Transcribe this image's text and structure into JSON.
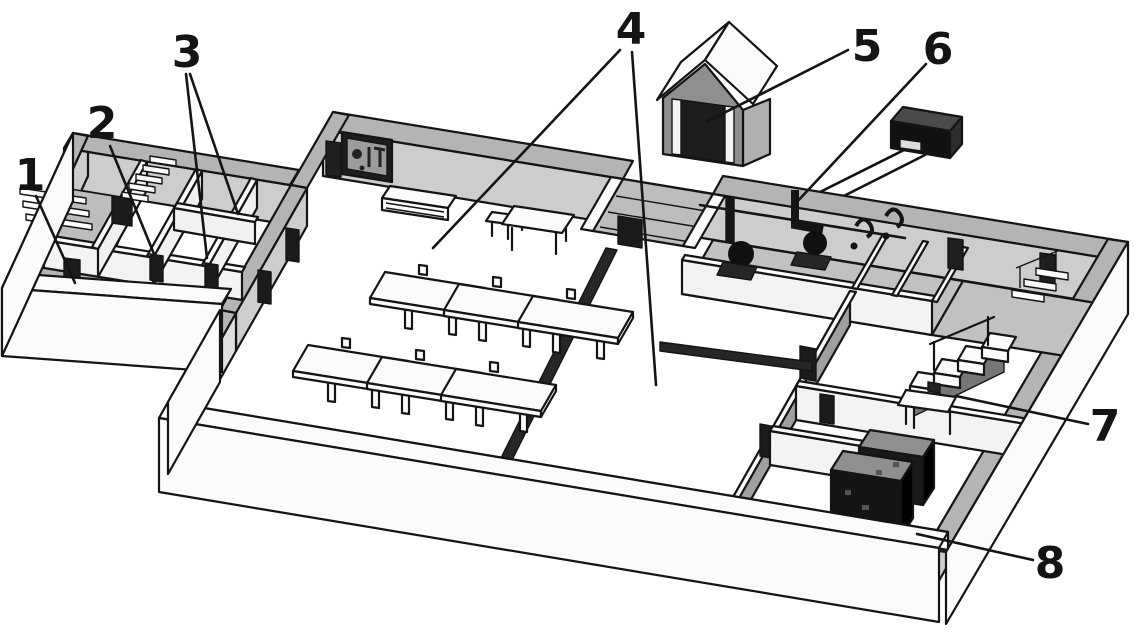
{
  "figure": {
    "kind": "isometric-cutaway-diagram",
    "palette": {
      "paper": "#ffffff",
      "ink": "#141414",
      "wall_top": "#b4b4b4",
      "wall_face": "#cdcdcd",
      "floor_shade": "#c1c1c1",
      "dark_fill": "#161616"
    }
  },
  "callouts": [
    {
      "label": "1",
      "x": 30,
      "y": 190,
      "lines": [
        [
          36,
          196,
          75,
          283
        ]
      ]
    },
    {
      "label": "2",
      "x": 102,
      "y": 138,
      "lines": [
        [
          110,
          146,
          154,
          254
        ]
      ]
    },
    {
      "label": "3",
      "x": 187,
      "y": 67,
      "lines": [
        [
          186,
          74,
          207,
          258
        ],
        [
          190,
          74,
          238,
          214
        ]
      ]
    },
    {
      "label": "4",
      "x": 631,
      "y": 44,
      "lines": [
        [
          620,
          50,
          433,
          248
        ],
        [
          632,
          52,
          656,
          385
        ]
      ]
    },
    {
      "label": "5",
      "x": 867,
      "y": 61,
      "lines": [
        [
          848,
          50,
          708,
          121
        ]
      ]
    },
    {
      "label": "6",
      "x": 938,
      "y": 64,
      "lines": [
        [
          926,
          64,
          795,
          204
        ]
      ]
    },
    {
      "label": "7",
      "x": 1105,
      "y": 441,
      "lines": [
        [
          1088,
          424,
          956,
          396
        ]
      ]
    },
    {
      "label": "8",
      "x": 1050,
      "y": 578,
      "lines": [
        [
          1033,
          560,
          917,
          534
        ]
      ]
    }
  ]
}
